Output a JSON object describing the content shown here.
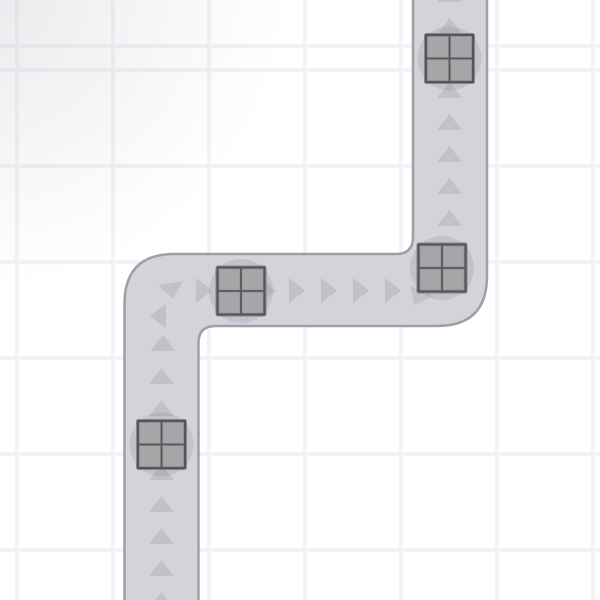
{
  "app": {
    "name": "conveyor-belt-game-board",
    "visible_text": []
  },
  "scene": {
    "canvas": {
      "width": 600,
      "height": 600
    },
    "background": {
      "color": "#ffffff",
      "grid_line_color": "#f3f3f6",
      "grid_spacing": 96,
      "grid_line_width": 4,
      "grid_offset_x": 15,
      "grid_offset_y": 48,
      "vignette_color": "rgba(148,148,166,0.20)",
      "vignette_transparent": "rgba(148,148,166,0)"
    },
    "conveyor": {
      "fill": "#d3d3d9",
      "border_color": "#9ea0a8",
      "border_width": 2.5,
      "outline_path": "M 124.5 612 L 124.5 304 Q 124.5 254 174.5 254 L 396 254 Q 413 254 413 237 L 413 -12 L 487 -12 L 487 276 Q 487 326 437 326 L 215.5 326 Q 198.5 326 198.5 343 L 198.5 612 Z",
      "route": "bottom-left up, turn right, across middle, turn up, exit top-right"
    },
    "arrows": {
      "color": "rgba(86,86,112,0.14)",
      "length": 16,
      "base_width": 25,
      "items": [
        {
          "x": 449.5,
          "y": -6,
          "rot": 0
        },
        {
          "x": 449.5,
          "y": 26,
          "rot": 0
        },
        {
          "x": 449.5,
          "y": 58,
          "rot": 0
        },
        {
          "x": 449.5,
          "y": 90,
          "rot": 0
        },
        {
          "x": 449.5,
          "y": 122,
          "rot": 0
        },
        {
          "x": 449.5,
          "y": 154,
          "rot": 0
        },
        {
          "x": 449.5,
          "y": 186,
          "rot": 0
        },
        {
          "x": 449.5,
          "y": 218,
          "rot": 0
        },
        {
          "x": 449.5,
          "y": 250,
          "rot": 0
        },
        {
          "x": 418,
          "y": 298,
          "rot": 205
        },
        {
          "x": 393,
          "y": 290.5,
          "rot": 90
        },
        {
          "x": 361,
          "y": 290.5,
          "rot": 90
        },
        {
          "x": 329,
          "y": 290.5,
          "rot": 90
        },
        {
          "x": 297,
          "y": 290.5,
          "rot": 90
        },
        {
          "x": 268,
          "y": 290.5,
          "rot": 90
        },
        {
          "x": 236,
          "y": 290.5,
          "rot": 90
        },
        {
          "x": 204,
          "y": 290.5,
          "rot": 90
        },
        {
          "x": 172,
          "y": 291,
          "rot": 170
        },
        {
          "x": 158,
          "y": 316,
          "rot": 270
        },
        {
          "x": 163,
          "y": 343,
          "rot": 0
        },
        {
          "x": 161.5,
          "y": 376,
          "rot": 0
        },
        {
          "x": 161.5,
          "y": 408,
          "rot": 0
        },
        {
          "x": 161.5,
          "y": 440,
          "rot": 0
        },
        {
          "x": 161.5,
          "y": 472,
          "rot": 0
        },
        {
          "x": 161.5,
          "y": 504,
          "rot": 0
        },
        {
          "x": 161.5,
          "y": 536,
          "rot": 0
        },
        {
          "x": 161.5,
          "y": 568,
          "rot": 0
        },
        {
          "x": 161.5,
          "y": 600,
          "rot": 0
        }
      ]
    },
    "crates": {
      "size": 50,
      "frame_color": "#55555b",
      "frame_edge_color": "#83838a",
      "pane_color": "#a6a6a9",
      "pane_edge_color": "#97979c",
      "frame_border": 3,
      "pane_gap": 2.5,
      "halo_color": "rgba(86,86,112,0.13)",
      "halo_radius": 32,
      "items": [
        {
          "x": 449.5,
          "y": 58.5
        },
        {
          "x": 442,
          "y": 268
        },
        {
          "x": 241,
          "y": 291
        },
        {
          "x": 161.5,
          "y": 444.5
        }
      ]
    }
  }
}
